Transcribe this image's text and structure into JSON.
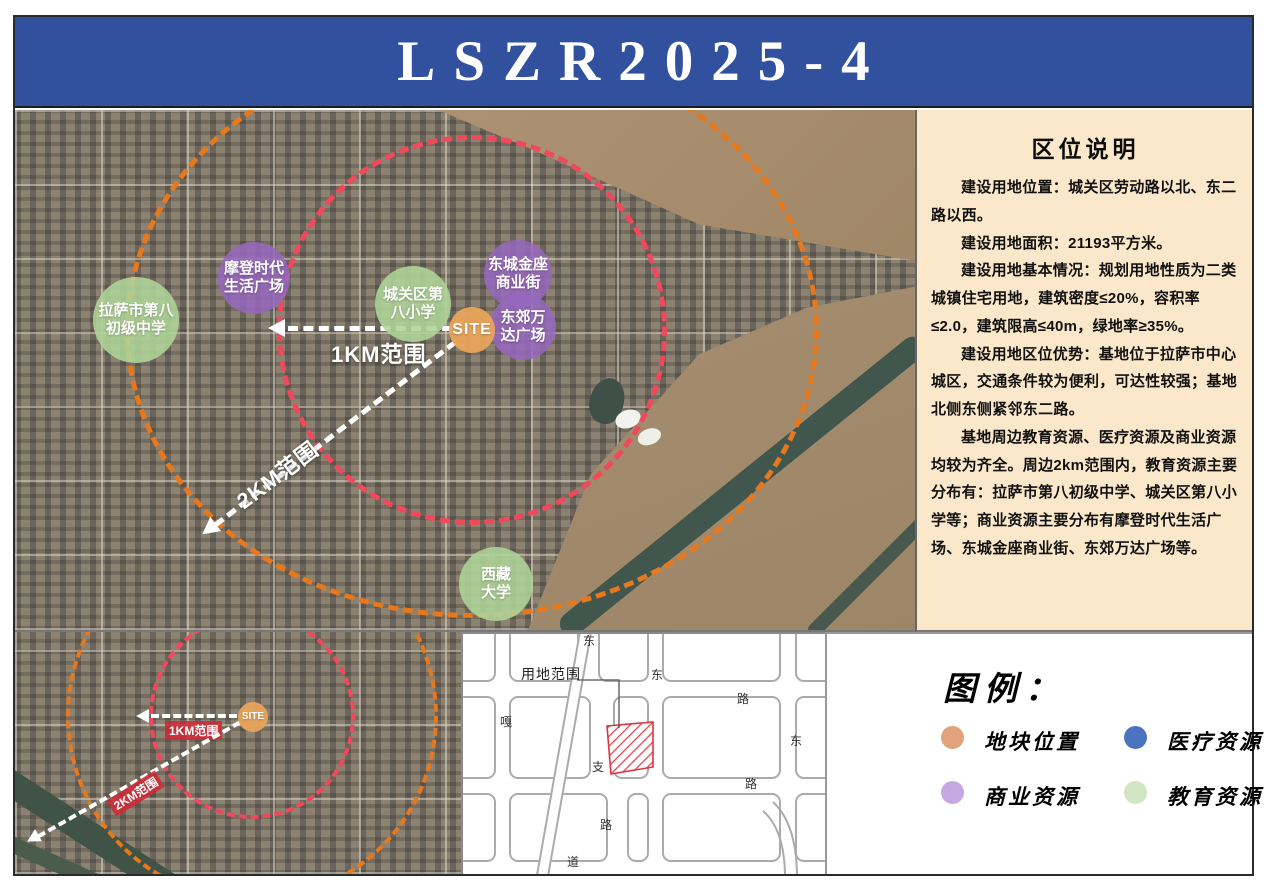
{
  "header": {
    "title": "LSZR2025-4"
  },
  "info_panel": {
    "title": "区位说明",
    "paragraphs": {
      "p1": "建设用地位置：城关区劳动路以北、东二路以西。",
      "p2": "建设用地面积：21193平方米。",
      "p3": "建设用地基本情况：规划用地性质为二类城镇住宅用地，建筑密度≤20%，容积率≤2.0，建筑限高≤40m，绿地率≥35%。",
      "p4": "建设用地区位优势：基地位于拉萨市中心城区，交通条件较为便利，可达性较强；基地北侧东侧紧邻东二路。",
      "p5": "基地周边教育资源、医疗资源及商业资源均较为齐全。周边2km范围内，教育资源主要分布有：拉萨市第八初级中学、城关区第八小学等；商业资源主要分布有摩登时代生活广场、东城金座商业街、东郊万达广场等。"
    }
  },
  "main_map": {
    "site_label": "SITE",
    "range_1km": "1KM范围",
    "range_2km": "2KM范围",
    "markers": [
      {
        "line1": "拉萨市第八",
        "line2": "初级中学",
        "type": "education"
      },
      {
        "line1": "摩登时代",
        "line2": "生活广场",
        "type": "commercial"
      },
      {
        "line1": "城关区第",
        "line2": "八小学",
        "type": "education"
      },
      {
        "line1": "东城金座",
        "line2": "商业街",
        "type": "commercial"
      },
      {
        "line1": "东郊万",
        "line2": "达广场",
        "type": "commercial"
      },
      {
        "line1": "西藏",
        "line2": "大学",
        "type": "education"
      }
    ]
  },
  "small_map": {
    "site_label": "SITE",
    "range_1km": "1KM范围",
    "range_2km": "2KM范围"
  },
  "plan_map": {
    "parcel_label": "用地范围",
    "road_chars": [
      {
        "ch": "东"
      },
      {
        "ch": "东"
      },
      {
        "ch": "路"
      },
      {
        "ch": "东"
      },
      {
        "ch": "路"
      },
      {
        "ch": "嘎"
      },
      {
        "ch": "支"
      },
      {
        "ch": "路"
      },
      {
        "ch": "道"
      }
    ]
  },
  "legend": {
    "title": "图例：",
    "items": [
      {
        "label": "地块位置",
        "color": "#e2a27c"
      },
      {
        "label": "医疗资源",
        "color": "#4a74c0"
      },
      {
        "label": "商业资源",
        "color": "#c5a8e2"
      },
      {
        "label": "教育资源",
        "color": "#d2e5c4"
      }
    ]
  },
  "colors": {
    "header_bg": "#31519e",
    "info_panel_bg": "#fbe7c9",
    "range_1km_ring": "#f0485c",
    "range_2km_ring": "#e6781e",
    "parcel_hatch": "#e23b47"
  }
}
